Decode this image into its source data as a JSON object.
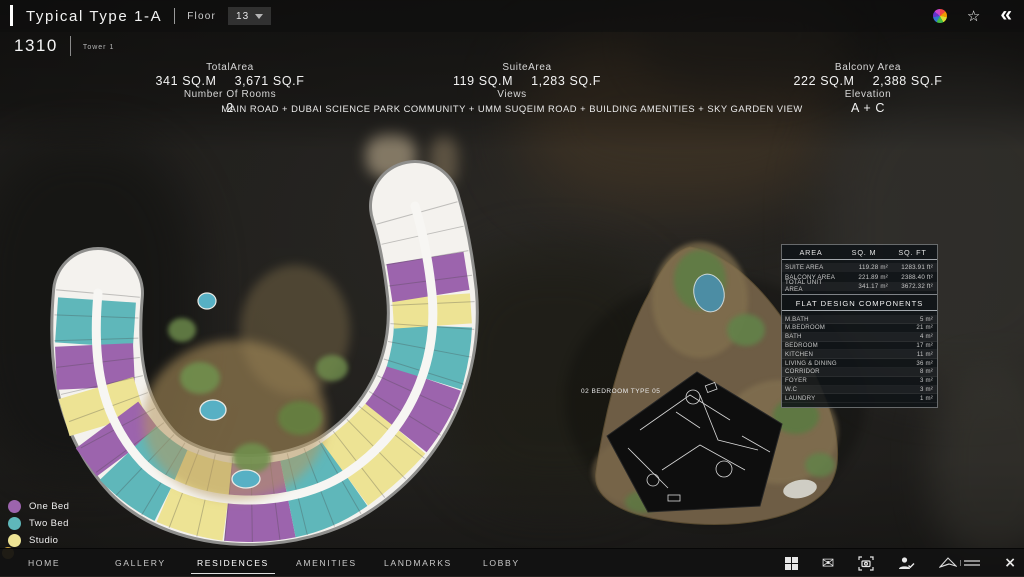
{
  "header": {
    "title": "Typical Type 1-A",
    "floor_label": "Floor",
    "floor_value": "13",
    "unit_number": "1310",
    "tower_label": "Tower 1"
  },
  "stats": {
    "total_area": {
      "label": "TotalArea",
      "sqm": "341 SQ.M",
      "sqf": "3,671 SQ.F"
    },
    "rooms": {
      "label": "Number Of Rooms",
      "value": "2"
    },
    "suite_area": {
      "label": "SuiteArea",
      "sqm": "119 SQ.M",
      "sqf": "1,283 SQ.F"
    },
    "views": {
      "label": "Views",
      "value": "MAIN ROAD + DUBAI SCIENCE PARK COMMUNITY + UMM SUQEIM ROAD + BUILDING AMENITIES + SKY GARDEN VIEW"
    },
    "balcony_area": {
      "label": "Balcony Area",
      "sqm": "222 SQ.M",
      "sqf": "2,388 SQ.F"
    },
    "elevation": {
      "label": "Elevation",
      "value": "A + C"
    }
  },
  "area_table": {
    "headers": [
      "AREA",
      "SQ. M",
      "SQ. FT"
    ],
    "unit_sqm": "m²",
    "unit_sqft": "ft²",
    "rows": [
      {
        "name": "SUITE AREA",
        "sqm": "119.28",
        "sqft": "1283.91"
      },
      {
        "name": "BALCONY AREA",
        "sqm": "221.89",
        "sqft": "2388.40"
      },
      {
        "name": "TOTAL UNIT AREA",
        "sqm": "341.17",
        "sqft": "3672.32"
      }
    ],
    "components_title": "FLAT DESIGN COMPONENTS",
    "components": [
      {
        "name": "M.BATH",
        "value": "5"
      },
      {
        "name": "M.BEDROOM",
        "value": "21"
      },
      {
        "name": "BATH",
        "value": "4"
      },
      {
        "name": "BEDROOM",
        "value": "17"
      },
      {
        "name": "KITCHEN",
        "value": "11"
      },
      {
        "name": "LIVING & DINING",
        "value": "36"
      },
      {
        "name": "CORRIDOR",
        "value": "8"
      },
      {
        "name": "FOYER",
        "value": "3"
      },
      {
        "name": "W.C",
        "value": "3"
      },
      {
        "name": "LAUNDRY",
        "value": "1"
      }
    ]
  },
  "detail_plan": {
    "label": "02 BEDROOM TYPE 05"
  },
  "legend": {
    "items": [
      {
        "label": "One Bed",
        "color": "#9c64ad"
      },
      {
        "label": "Two Bed",
        "color": "#5fb7ba"
      },
      {
        "label": "Studio",
        "color": "#ede394"
      }
    ]
  },
  "nav": {
    "items": [
      "HOME",
      "GALLERY",
      "RESIDENCES",
      "AMENITIES",
      "LANDMARKS",
      "LOBBY"
    ],
    "active": "RESIDENCES"
  },
  "icons": {
    "star_glyph": "☆",
    "collapse_glyph": "«",
    "mail_glyph": "✉",
    "close_glyph": "×"
  },
  "colors": {
    "one_bed": "#9c64ad",
    "two_bed": "#5fb7ba",
    "studio": "#ede394",
    "pool": "#57b0c4",
    "corridor_white": "#f4f2ee"
  }
}
